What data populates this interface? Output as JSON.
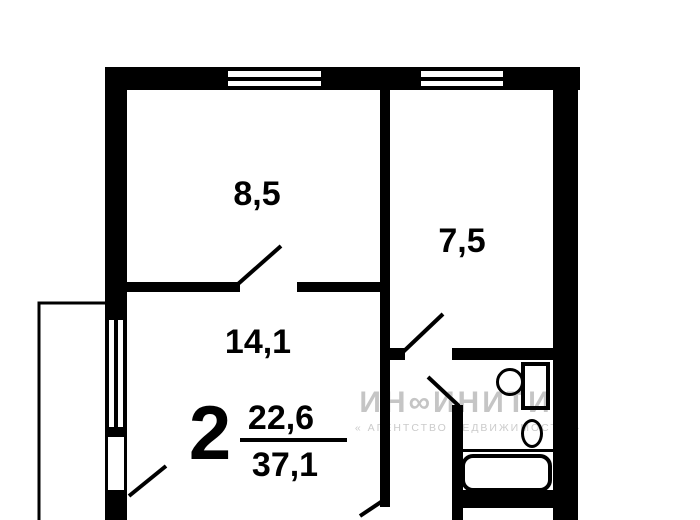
{
  "plan": {
    "type": "apartment-floor-plan",
    "rooms": [
      {
        "name": "room-top-left",
        "area": "8,5"
      },
      {
        "name": "kitchen-top-right",
        "area": "7,5"
      },
      {
        "name": "living-room",
        "area": "14,1"
      }
    ],
    "summary": {
      "rooms_count": "2",
      "living_area": "22,6",
      "total_area": "37,1"
    }
  },
  "watermark": {
    "brand": "ИН∞ИНИТИ",
    "subtitle": "« АГЕНТСТВО НЕДВИЖИМОСТИ »"
  },
  "colors": {
    "wall": "#000000",
    "background": "#ffffff",
    "watermark_brand": "#c5c5c5",
    "watermark_subtitle": "#cbcbcb"
  }
}
